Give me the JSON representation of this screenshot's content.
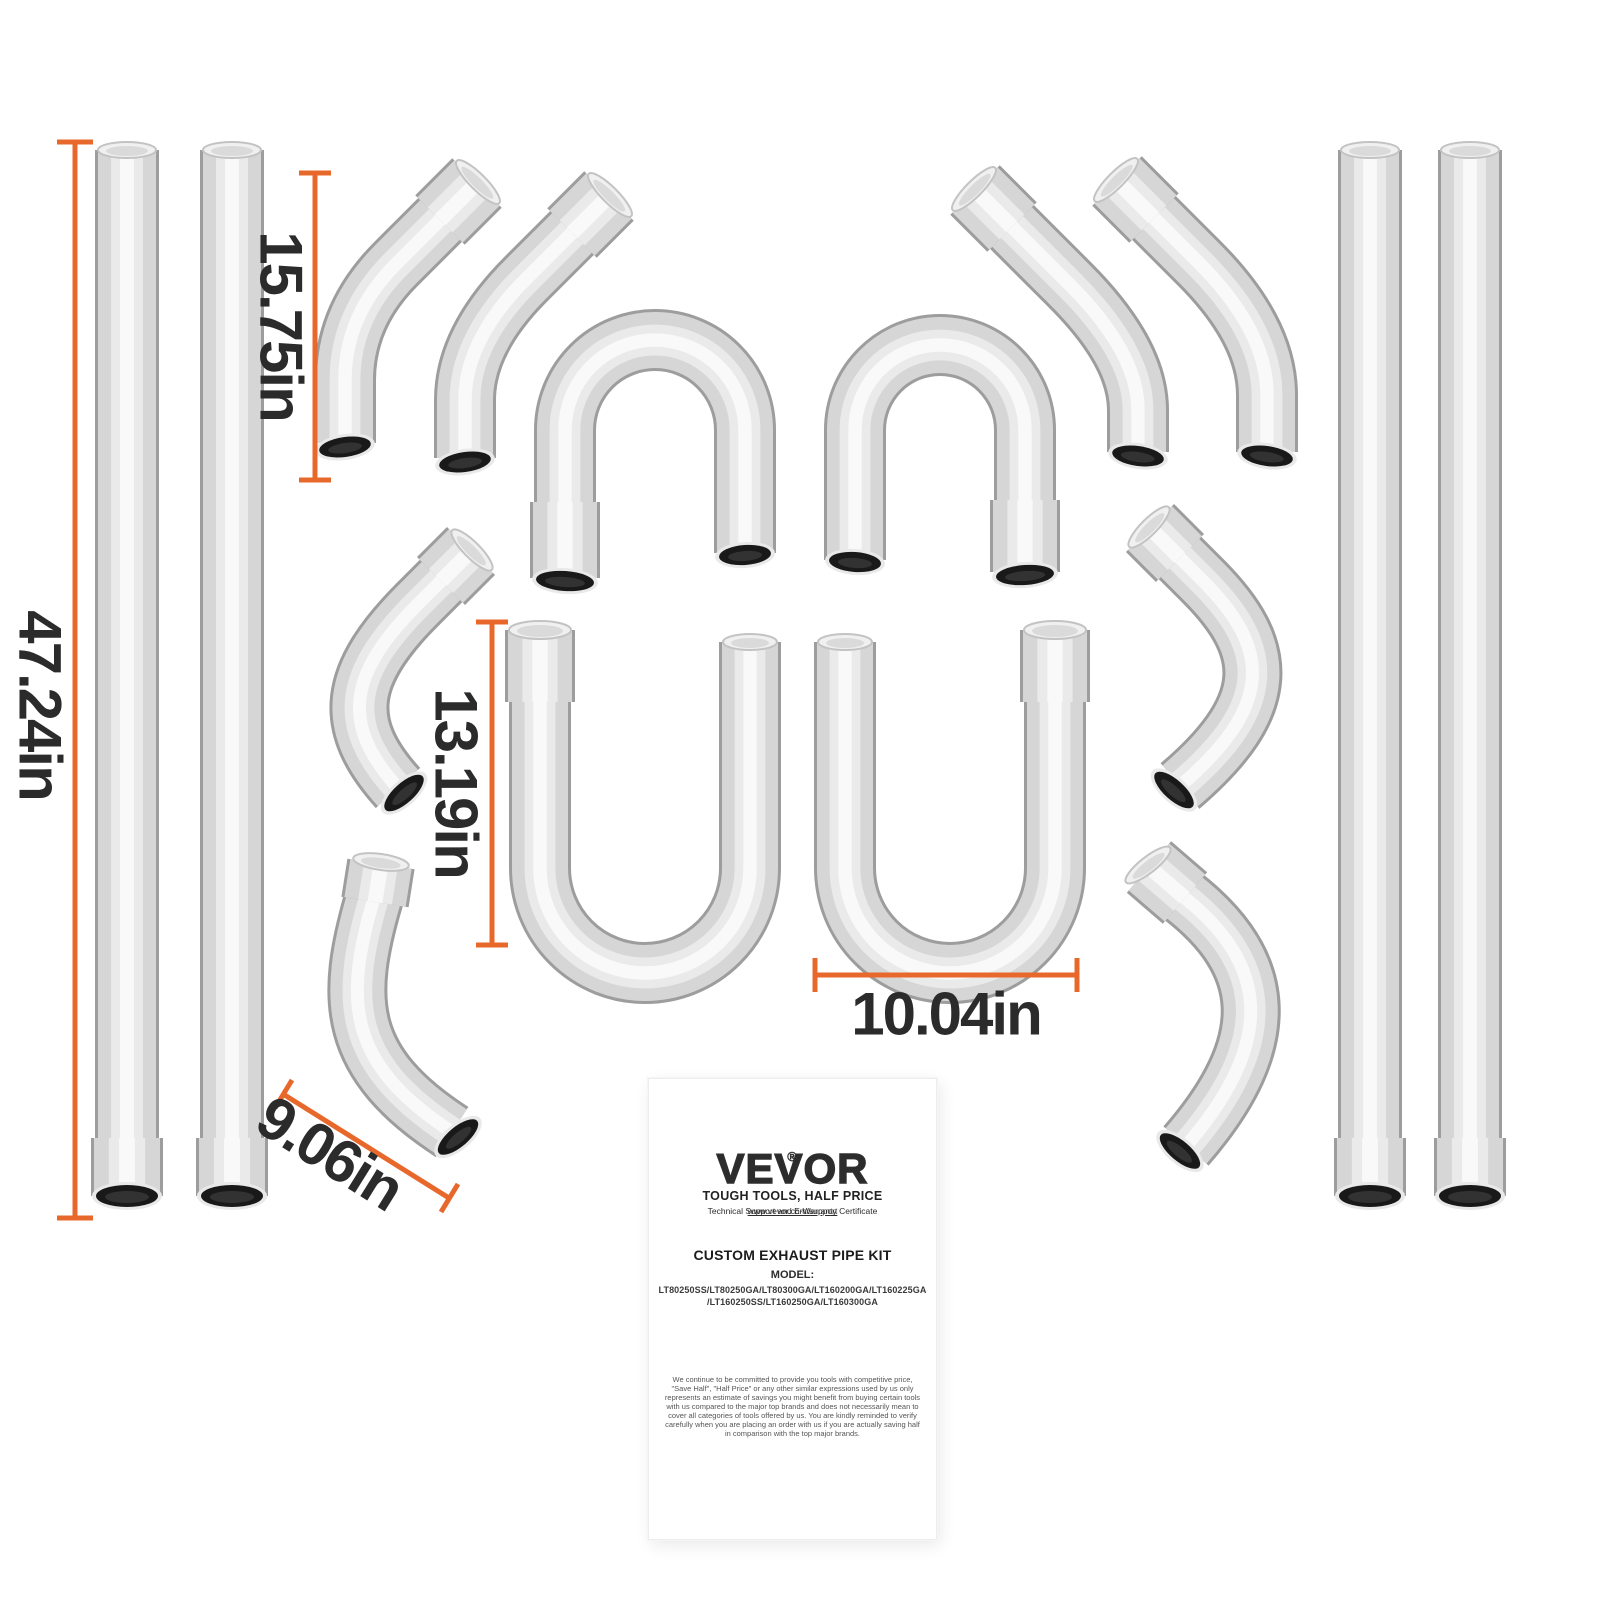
{
  "dimensions": {
    "straight_pipe": "47.24in",
    "elbow_45": "15.75in",
    "j_bend_height": "13.19in",
    "j_bend_width": "10.04in",
    "elbow_90": "9.06in"
  },
  "card": {
    "brand": "VEVOR",
    "registered": "®",
    "slogan": "TOUGH TOOLS, HALF PRICE",
    "support_text": "Technical Support and E-Warranty Certificate ",
    "support_url": "www.vevor.com/support",
    "kit_title": "CUSTOM EXHAUST PIPE KIT",
    "model_label": "MODEL:",
    "model_line1": "LT80250SS/LT80250GA/LT80300GA/LT160200GA/LT160225GA",
    "model_line2": "/LT160250SS/LT160250GA/LT160300GA",
    "disclaimer": "We continue to be committed to provide you tools with competitive price, \"Save Half\", \"Half Price\" or any other similar expressions used by us only represents an estimate of savings you might benefit from buying certain tools with us compared to the major top brands and does not necessarily mean to cover all categories of tools offered by us. You are kindly reminded to verify carefully when you are placing an order with us if you are actually saving half in comparison with the top major brands."
  },
  "colors": {
    "dimension_line": "#e8682c",
    "label_text": "#2b2b2b"
  }
}
